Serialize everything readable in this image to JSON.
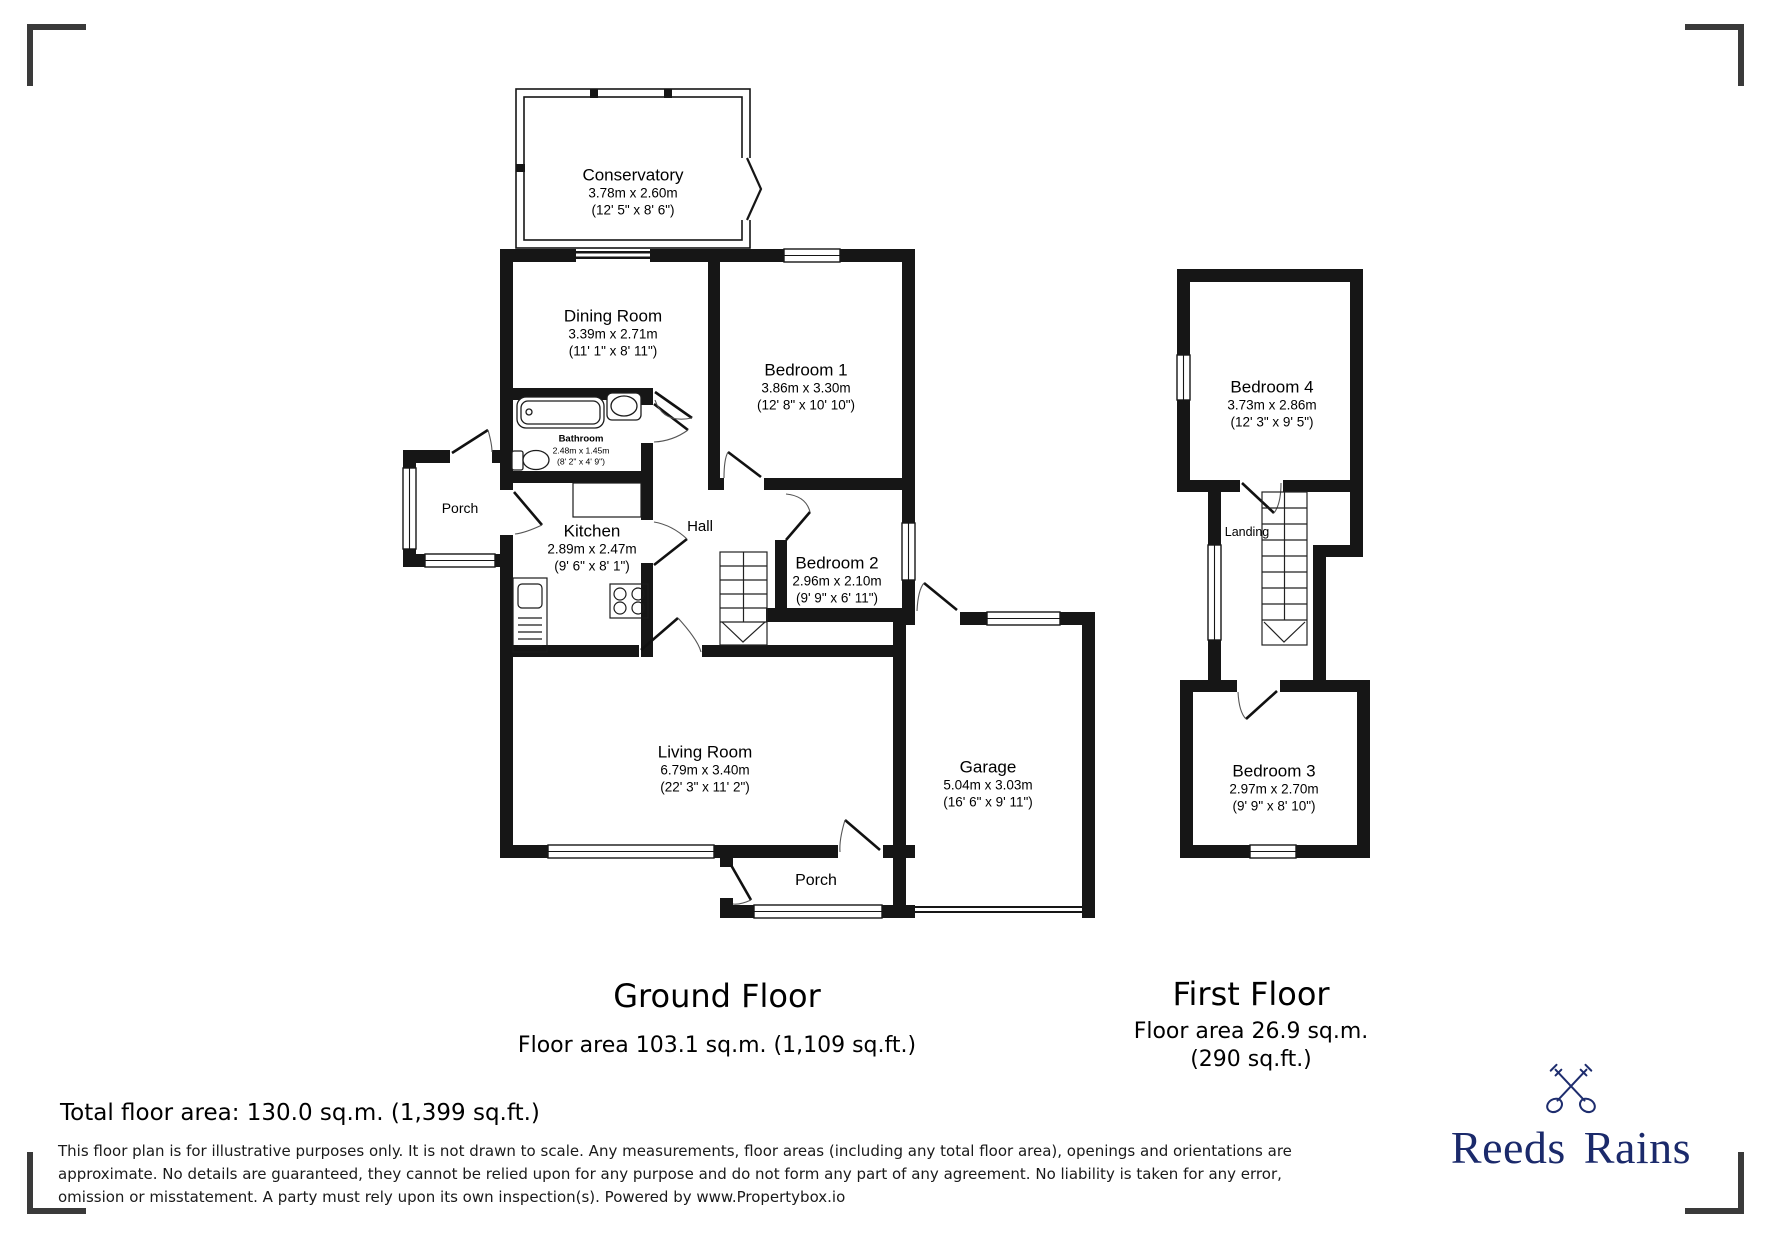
{
  "ground_floor": {
    "heading": "Ground Floor",
    "area_line": "Floor area 103.1 sq.m. (1,109 sq.ft.)",
    "rooms": {
      "conservatory": {
        "name": "Conservatory",
        "metric": "3.78m x 2.60m",
        "imperial": "(12' 5\" x 8' 6\")"
      },
      "dining": {
        "name": "Dining Room",
        "metric": "3.39m x 2.71m",
        "imperial": "(11' 1\" x 8' 11\")"
      },
      "bedroom1": {
        "name": "Bedroom 1",
        "metric": "3.86m x 3.30m",
        "imperial": "(12' 8\" x 10' 10\")"
      },
      "bathroom": {
        "name": "Bathroom",
        "metric": "2.48m x 1.45m",
        "imperial": "(8' 2\" x 4' 9\")"
      },
      "porch_side": {
        "name": "Porch"
      },
      "kitchen": {
        "name": "Kitchen",
        "metric": "2.89m x 2.47m",
        "imperial": "(9' 6\" x 8' 1\")"
      },
      "hall": {
        "name": "Hall"
      },
      "bedroom2": {
        "name": "Bedroom 2",
        "metric": "2.96m x 2.10m",
        "imperial": "(9' 9\" x 6' 11\")"
      },
      "living": {
        "name": "Living Room",
        "metric": "6.79m x 3.40m",
        "imperial": "(22' 3\" x 11' 2\")"
      },
      "garage": {
        "name": "Garage",
        "metric": "5.04m x 3.03m",
        "imperial": "(16' 6\" x 9' 11\")"
      },
      "porch_front": {
        "name": "Porch"
      }
    }
  },
  "first_floor": {
    "heading": "First Floor",
    "area_line1": "Floor area 26.9 sq.m.",
    "area_line2": "(290 sq.ft.)",
    "rooms": {
      "bedroom4": {
        "name": "Bedroom 4",
        "metric": "3.73m x 2.86m",
        "imperial": "(12' 3\" x 9' 5\")"
      },
      "landing": {
        "name": "Landing"
      },
      "bedroom3": {
        "name": "Bedroom 3",
        "metric": "2.97m x 2.70m",
        "imperial": "(9' 9\" x 8' 10\")"
      }
    }
  },
  "summary": {
    "total": "Total floor area: 130.0 sq.m. (1,399 sq.ft.)"
  },
  "disclaimer": "This floor plan is for illustrative purposes only. It is not drawn to scale. Any measurements, floor areas (including any total floor area), openings and orientations are approximate. No details are guaranteed, they cannot be relied upon for any purpose and do not form any part of any agreement. No liability is taken for any error, omission or misstatement. A party must rely upon its own inspection(s). Powered by www.Propertybox.io",
  "brand": {
    "name": "Reeds Rains",
    "color": "#1b2a6b",
    "icon": "crossed-keys"
  }
}
